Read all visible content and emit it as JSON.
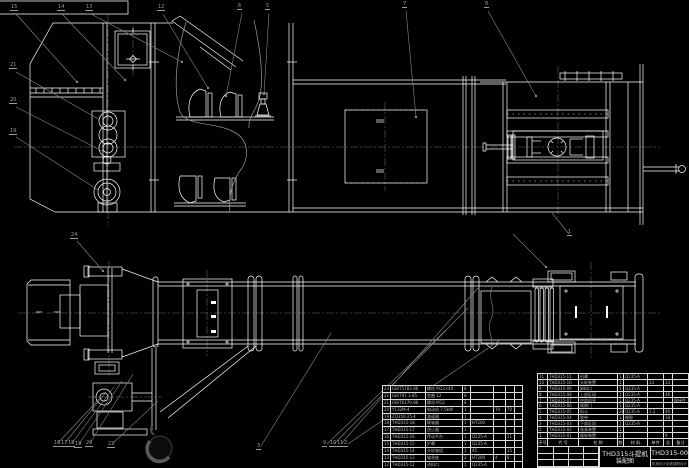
{
  "colors": {
    "background": "#000000",
    "drawing_line": "#ffffff",
    "leader_line": "#8a8a8a",
    "centerline": "#6a6a6a",
    "table_text": "#b9b9b9"
  },
  "title_block": {
    "product": "THD315斗提机",
    "drawing_type": "装配图",
    "drawing_no": "THD315-00",
    "bottom_note": "机械设计制造课程设计"
  },
  "bom_right": {
    "header": [
      "序号",
      "代 号",
      "名 称",
      "数量",
      "材 料",
      "单件",
      "总计",
      "备注"
    ],
    "rows": [
      [
        "11",
        "THD315-11",
        "机罩",
        "1",
        "Q235-A",
        "",
        "",
        ""
      ],
      [
        "10",
        "THD315-10",
        "头轮装置",
        "1",
        "",
        "13",
        "13",
        ""
      ],
      [
        "9",
        "THD315-09",
        "卸料口",
        "1",
        "Q235-A",
        "",
        "",
        ""
      ],
      [
        "8",
        "THD315-08",
        "上部区段",
        "1",
        "Q235-A",
        "",
        "46",
        ""
      ],
      [
        "7",
        "THD315-07",
        "中部机壳",
        "1",
        "Q235-A",
        "",
        "",
        "焊接件"
      ],
      [
        "6",
        "THD315-06",
        "观察门",
        "1",
        "Q235-A",
        "",
        "",
        ""
      ],
      [
        "5",
        "THD315-05",
        "料斗",
        "38",
        "Q235-A",
        "1.2",
        "46",
        ""
      ],
      [
        "4",
        "THD315-04",
        "胶带",
        "1",
        "橡胶",
        "",
        "18",
        ""
      ],
      [
        "3",
        "THD315-03",
        "下部区段",
        "1",
        "Q235-A",
        "",
        "",
        ""
      ],
      [
        "2",
        "THD315-02",
        "张紧装置",
        "1",
        "",
        "",
        "",
        ""
      ],
      [
        "1",
        "THD315-01",
        "尾轮装置",
        "1",
        "",
        "",
        "9",
        ""
      ]
    ]
  },
  "bom_left": {
    "rows": [
      [
        "23",
        "GB/T5782-86",
        "螺栓 M12×40",
        "8",
        "",
        "",
        "",
        ""
      ],
      [
        "22",
        "GB/T97.1-85",
        "垫圈 12",
        "8",
        "",
        "",
        "",
        ""
      ],
      [
        "21",
        "GB/T6170-86",
        "螺母 M12",
        "8",
        "",
        "",
        "",
        ""
      ],
      [
        "20",
        "Y132M-4",
        "电动机 7.5kW",
        "1",
        "",
        "70",
        "70",
        ""
      ],
      [
        "19",
        "ZQ350-25-Ⅱ",
        "减速器",
        "1",
        "",
        "",
        "",
        ""
      ],
      [
        "18",
        "THD315-18",
        "联轴器",
        "1",
        "HT200",
        "",
        "",
        ""
      ],
      [
        "17",
        "THD315-17",
        "逆止器",
        "1",
        "",
        "",
        "",
        ""
      ],
      [
        "16",
        "THD315-16",
        "传动平台",
        "1",
        "Q235-A",
        "",
        "21",
        ""
      ],
      [
        "15",
        "THD315-15",
        "护罩",
        "1",
        "Q235-A",
        "",
        "",
        ""
      ],
      [
        "14",
        "THD315-14",
        "头轮轴组",
        "1",
        "45",
        "",
        "15",
        ""
      ],
      [
        "13",
        "THD315-13",
        "轴承座",
        "2",
        "HT200",
        "4",
        "8",
        ""
      ],
      [
        "12",
        "THD315-12",
        "进料口",
        "1",
        "Q235-A",
        "",
        "",
        ""
      ]
    ]
  },
  "callouts": {
    "items": [
      {
        "label": "15",
        "x": 10,
        "y": 5
      },
      {
        "label": "14",
        "x": 57,
        "y": 5
      },
      {
        "label": "13",
        "x": 85,
        "y": 5
      },
      {
        "label": "12",
        "x": 157,
        "y": 5
      },
      {
        "label": "6",
        "x": 237,
        "y": 4
      },
      {
        "label": "5",
        "x": 265,
        "y": 4
      },
      {
        "label": "7",
        "x": 402,
        "y": 2
      },
      {
        "label": "8",
        "x": 484,
        "y": 2
      },
      {
        "label": "21",
        "x": 9,
        "y": 63
      },
      {
        "label": "20",
        "x": 9,
        "y": 98
      },
      {
        "label": "19",
        "x": 9,
        "y": 129
      },
      {
        "label": "24",
        "x": 70,
        "y": 233
      },
      {
        "label": "1",
        "x": 567,
        "y": 230
      },
      {
        "label": "16",
        "x": 53,
        "y": 441
      },
      {
        "label": "17",
        "x": 60,
        "y": 441
      },
      {
        "label": "18",
        "x": 67,
        "y": 441
      },
      {
        "label": "19",
        "x": 74,
        "y": 442
      },
      {
        "label": "20",
        "x": 85,
        "y": 441
      },
      {
        "label": "22",
        "x": 107,
        "y": 442
      },
      {
        "label": "3",
        "x": 256,
        "y": 444
      },
      {
        "label": "9",
        "x": 322,
        "y": 441
      },
      {
        "label": "10",
        "x": 329,
        "y": 441
      },
      {
        "label": "11",
        "x": 336,
        "y": 441
      },
      {
        "label": "2",
        "x": 343,
        "y": 441
      }
    ]
  }
}
